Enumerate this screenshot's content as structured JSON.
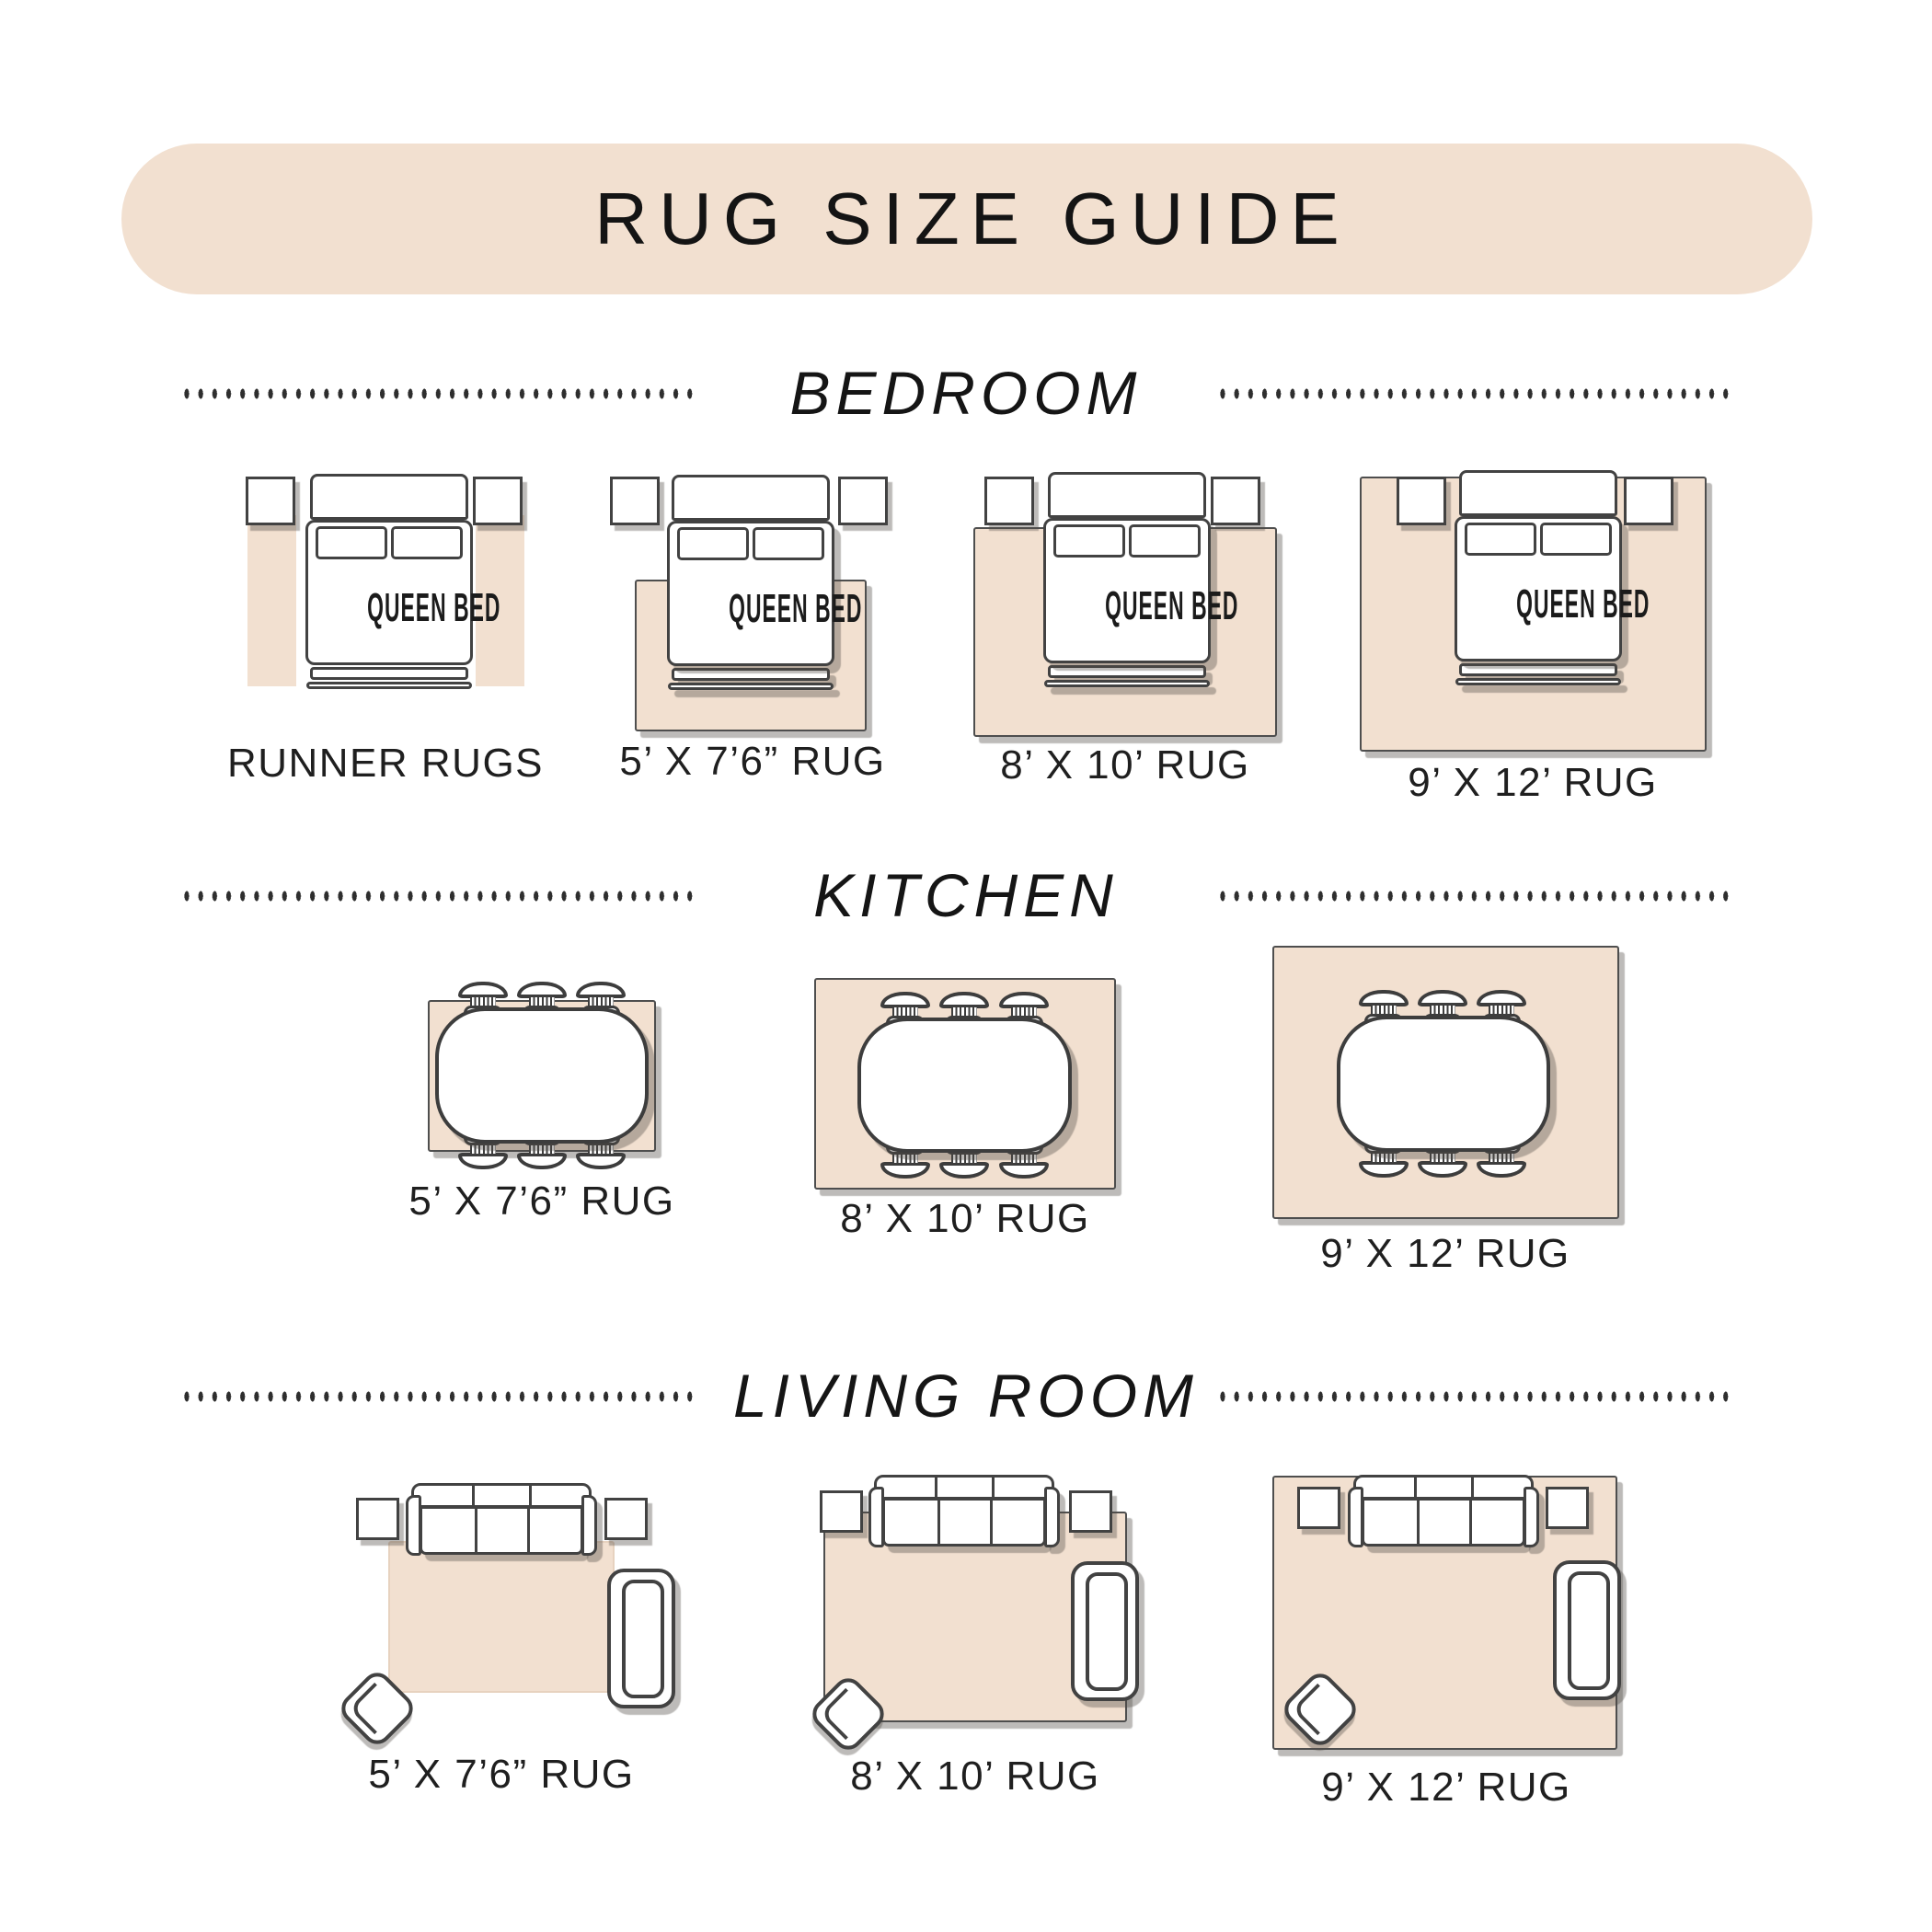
{
  "title": "RUG SIZE GUIDE",
  "bed_label": "QUEEN BED",
  "colors": {
    "accent_beige": "#f2e0d0",
    "outline_dark": "#424242",
    "text_dark": "#1f1f1f"
  },
  "sections": {
    "bedroom": {
      "heading": "BEDROOM",
      "items": [
        {
          "label": "RUNNER RUGS"
        },
        {
          "label": "5’ X 7’6” RUG"
        },
        {
          "label": "8’ X 10’ RUG"
        },
        {
          "label": "9’ X 12’ RUG"
        }
      ]
    },
    "kitchen": {
      "heading": "KITCHEN",
      "items": [
        {
          "label": "5’ X 7’6” RUG"
        },
        {
          "label": "8’ X 10’ RUG"
        },
        {
          "label": "9’ X 12’ RUG"
        }
      ]
    },
    "living_room": {
      "heading": "LIVING ROOM",
      "items": [
        {
          "label": "5’ X 7’6” RUG"
        },
        {
          "label": "8’ X 10’ RUG"
        },
        {
          "label": "9’ X 12’ RUG"
        }
      ]
    }
  }
}
